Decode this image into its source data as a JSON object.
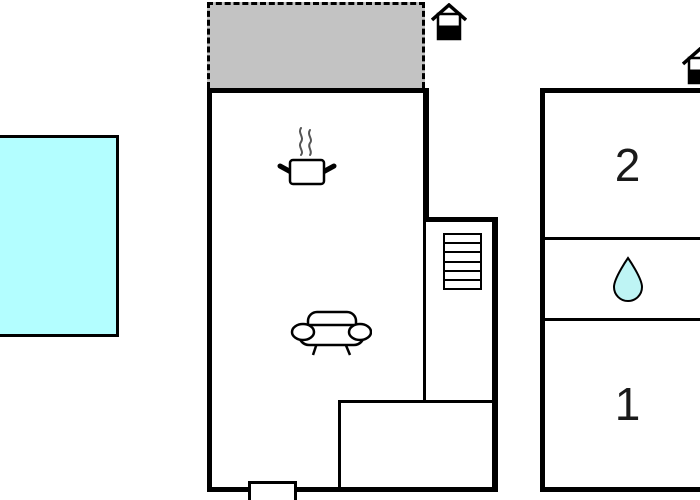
{
  "floorplan": {
    "colors": {
      "background": "#FFFFFF",
      "wall": "#000000",
      "pool_fill": "#B3FEFF",
      "terrace_fill": "#C3C3C3",
      "drop_fill": "#BEF4F4",
      "steam": "#555555"
    },
    "annex": {
      "room2_label": "2",
      "room1_label": "1"
    },
    "icons": {
      "main_entrance": "house-icon",
      "annex_entrance": "house-icon",
      "kitchen": "cooking-pot-icon",
      "living_room": "sofa-icon",
      "staircase": "stairs-icon",
      "bathroom": "water-drop-icon"
    }
  }
}
